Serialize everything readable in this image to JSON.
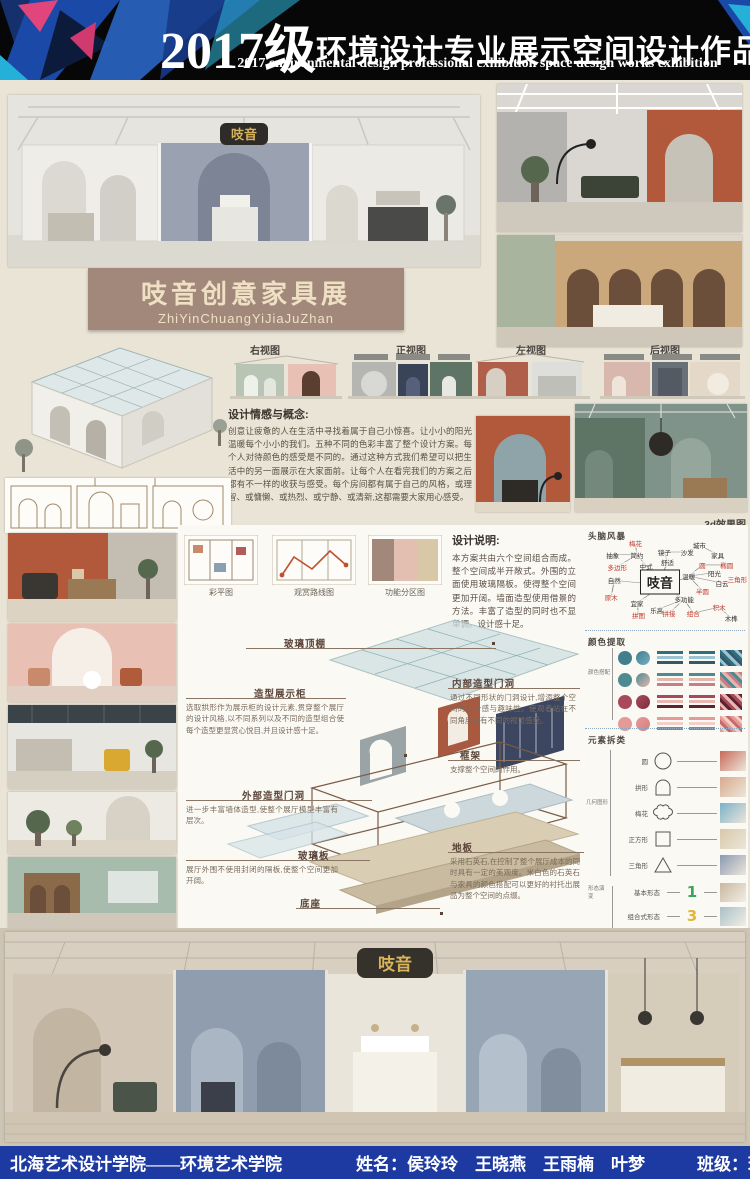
{
  "header": {
    "title_year": "2017级",
    "title_cn": "环境设计专业展示空间设计作品展",
    "subtitle_en": "2017 environmental design professional exhibition space design works exhibition"
  },
  "banner": {
    "title": "吱音创意家具展",
    "pinyin": "ZhiYinChuangYiJiaJuZhan"
  },
  "sign_logo": "吱音",
  "views": {
    "right": "右视图",
    "front": "正视图",
    "left": "左视图",
    "back": "后视图"
  },
  "concept": {
    "heading": "设计情感与概念:",
    "body": "创意让疲惫的人在生活中寻找着属于自己小惊喜。让小小的阳光温暖每个小小的我们。五种不同的色彩丰富了整个设计方案。每个人对待颜色的感受是不同的。通过这种方式我们希望可以把生活中的另一面展示在大家面前。让每个人在看完我们的方案之后都有不一样的收获与感受。每个房间都有属于自己的风格，或理智、或慵懒、或热烈、或宁静、或清新,这都需要大家用心感受。"
  },
  "render3d_label": "3d效果图",
  "plans": {
    "items": [
      "彩平图",
      "观赏路线图",
      "功能分区图"
    ]
  },
  "design_note": {
    "heading": "设计说明:",
    "body": "本方案共由六个空间组合而成。整个空间成半开敞式。外围的立面使用玻璃隔板。使得整个空间更加开阔。墙面造型使用借景的方法。丰富了造型的同时也不显单调。设计感十足。"
  },
  "exploded": {
    "glass_roof": {
      "label": "玻璃顶棚"
    },
    "display_cabinet": {
      "label": "造型展示柜",
      "desc": "选取拱形作为展示柜的设计元素,贯穿整个展厅的设计风格,以不同系列以及不同的造型组合使每个造型更显赏心悦目,并且设计感十足。"
    },
    "inner_arch": {
      "label": "内部造型门洞",
      "desc": "通过不同形状的门洞设计,增添整个空间的设计感与趣味性。使观者站在不同角度会有不同的视觉感受。"
    },
    "frame": {
      "label": "框架",
      "desc": "支撑整个空间的作用。"
    },
    "outer_arch": {
      "label": "外部造型门洞",
      "desc": "进一步丰富墙体造型,使整个展厅模型丰富有层次。"
    },
    "glass_panel": {
      "label": "玻璃板",
      "desc": "展厅外围不使用封闭的隔板,使整个空间更加开阔。"
    },
    "floor": {
      "label": "地板",
      "desc": "采用石英石,在控制了整个展厅成本的同时具有一定的美观度。米白色的石英石与家具的颜色搭配可以更好的衬托出展品为整个空间的点缀。"
    },
    "base": {
      "label": "底座"
    }
  },
  "brainstorm": {
    "heading": "头脑风暴",
    "center": "吱音",
    "nodes": [
      {
        "label": "梅花",
        "x": 26,
        "y": 4,
        "red": true
      },
      {
        "label": "城市",
        "x": 68,
        "y": 6,
        "red": false
      },
      {
        "label": "抽象",
        "x": 11,
        "y": 17,
        "red": false
      },
      {
        "label": "简约",
        "x": 27,
        "y": 17,
        "red": false
      },
      {
        "label": "镜子",
        "x": 45,
        "y": 14,
        "red": false
      },
      {
        "label": "沙发",
        "x": 60,
        "y": 14,
        "red": false
      },
      {
        "label": "家具",
        "x": 80,
        "y": 17,
        "red": false
      },
      {
        "label": "多边形",
        "x": 14,
        "y": 31,
        "red": true
      },
      {
        "label": "中式",
        "x": 33,
        "y": 30,
        "red": false
      },
      {
        "label": "舒适",
        "x": 47,
        "y": 26,
        "red": false
      },
      {
        "label": "圆",
        "x": 70,
        "y": 29,
        "red": true
      },
      {
        "label": "椭圆",
        "x": 86,
        "y": 29,
        "red": true
      },
      {
        "label": "温暖",
        "x": 61,
        "y": 42,
        "red": false
      },
      {
        "label": "阳光",
        "x": 78,
        "y": 38,
        "red": false
      },
      {
        "label": "自然",
        "x": 12,
        "y": 47,
        "red": false
      },
      {
        "label": "白云",
        "x": 83,
        "y": 50,
        "red": false
      },
      {
        "label": "三角形",
        "x": 93,
        "y": 45,
        "red": true
      },
      {
        "label": "半圆",
        "x": 70,
        "y": 59,
        "red": true
      },
      {
        "label": "原木",
        "x": 10,
        "y": 66,
        "red": true
      },
      {
        "label": "宜家",
        "x": 27,
        "y": 73,
        "red": false
      },
      {
        "label": "多功能",
        "x": 58,
        "y": 69,
        "red": false
      },
      {
        "label": "乐高",
        "x": 40,
        "y": 81,
        "red": false
      },
      {
        "label": "拼图",
        "x": 28,
        "y": 87,
        "red": true
      },
      {
        "label": "拼接",
        "x": 48,
        "y": 85,
        "red": true
      },
      {
        "label": "组合",
        "x": 64,
        "y": 85,
        "red": true
      },
      {
        "label": "积木",
        "x": 81,
        "y": 78,
        "red": true
      },
      {
        "label": "木榫",
        "x": 89,
        "y": 91,
        "red": false
      }
    ]
  },
  "palette": {
    "heading": "颜色提取",
    "connector_label": "颜色搭配",
    "rows": [
      {
        "c1": "#417f8d",
        "c2": "#79aec3",
        "stripes": [
          "#2e6f80",
          "#9cc4d4",
          "#35586b"
        ]
      },
      {
        "c1": "#4d8b90",
        "c2": "#e4b7ae",
        "stripes": [
          "#4d8b90",
          "#e4b7ae",
          "#c77f85"
        ]
      },
      {
        "c1": "#a84a5c",
        "c2": "#7e2f3e",
        "stripes": [
          "#a84a5c",
          "#e8b8b0",
          "#5e2330"
        ]
      },
      {
        "c1": "#e59a98",
        "c2": "#d97f7f",
        "stripes": [
          "#e59a98",
          "#f2cfc8",
          "#c96a6a"
        ]
      }
    ]
  },
  "elements": {
    "heading": "元素拆类",
    "group_label": "几何图形",
    "shapes": [
      {
        "label": "圆",
        "type": "circle",
        "thumb": "#c86a5a"
      },
      {
        "label": "拱形",
        "type": "arch",
        "thumb": "#d8a98e"
      },
      {
        "label": "梅花",
        "type": "flower",
        "thumb": "#7ab0c8"
      },
      {
        "label": "正方形",
        "type": "square",
        "thumb": "#d8c8a8"
      },
      {
        "label": "三角形",
        "type": "triangle",
        "thumb": "#8a9ab0"
      }
    ],
    "forms_label": "形态演变",
    "forms": [
      {
        "label": "基本形态",
        "glyph": "1",
        "color": "#3aa65c",
        "thumb": "#c8b8a0"
      },
      {
        "label": "组合式形态",
        "glyph": "3",
        "color": "#e0b73a",
        "thumb": "#a8c0c8"
      },
      {
        "label": "近似形态",
        "glyph": "S",
        "color": "#3a7fc0",
        "thumb": "#d8c060"
      },
      {
        "label": "堆叠形态",
        "glyph": "2",
        "color": "#e0703a",
        "thumb": "#b0b8a8"
      }
    ]
  },
  "footer": {
    "school": "北海艺术设计学院——环境艺术学院",
    "names_label": "姓名：",
    "names": "侯玲玲　王晓燕　王雨楠　叶梦",
    "class_label": "班级：",
    "class_value": "环本１７１６班"
  }
}
